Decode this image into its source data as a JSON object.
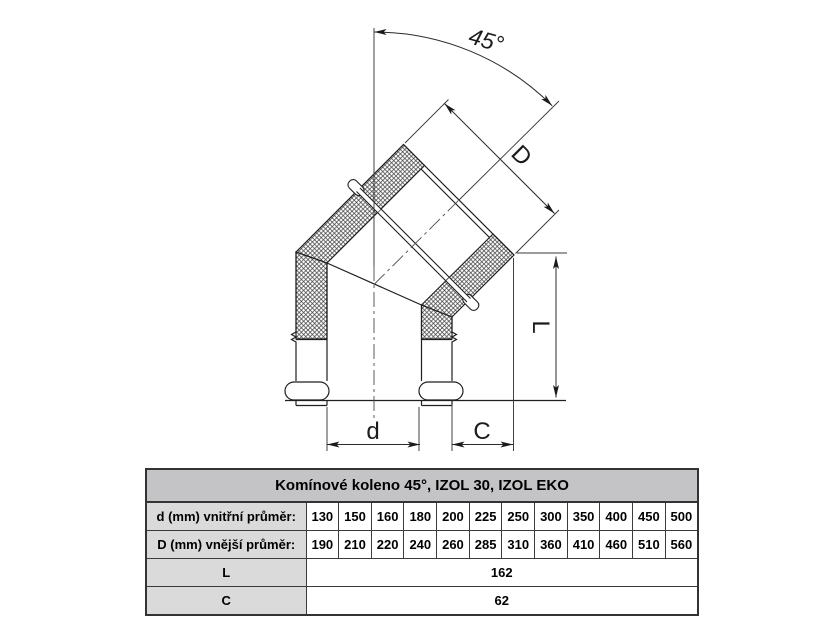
{
  "drawing": {
    "labels": {
      "angle": "45°",
      "outer_diameter": "D",
      "length": "L",
      "inner_diameter": "d",
      "offset": "C"
    },
    "line_color": "#1f1f1f",
    "centerline_color": "#4a4a4a"
  },
  "table": {
    "title": "Komínové koleno 45°, IZOL 30, IZOL EKO",
    "rows": [
      {
        "label": "d (mm) vnitřní průměr:",
        "values": [
          "130",
          "150",
          "160",
          "180",
          "200",
          "225",
          "250",
          "300",
          "350",
          "400",
          "450",
          "500"
        ]
      },
      {
        "label": "D (mm) vnější průměr:",
        "values": [
          "190",
          "210",
          "220",
          "240",
          "260",
          "285",
          "310",
          "360",
          "410",
          "460",
          "510",
          "560"
        ]
      },
      {
        "label": "L",
        "value": "162"
      },
      {
        "label": "C",
        "value": "62"
      }
    ],
    "colors": {
      "title_bg": "#c4c4c6",
      "label_bg": "#dadada",
      "border": "#3b3b3b"
    }
  }
}
